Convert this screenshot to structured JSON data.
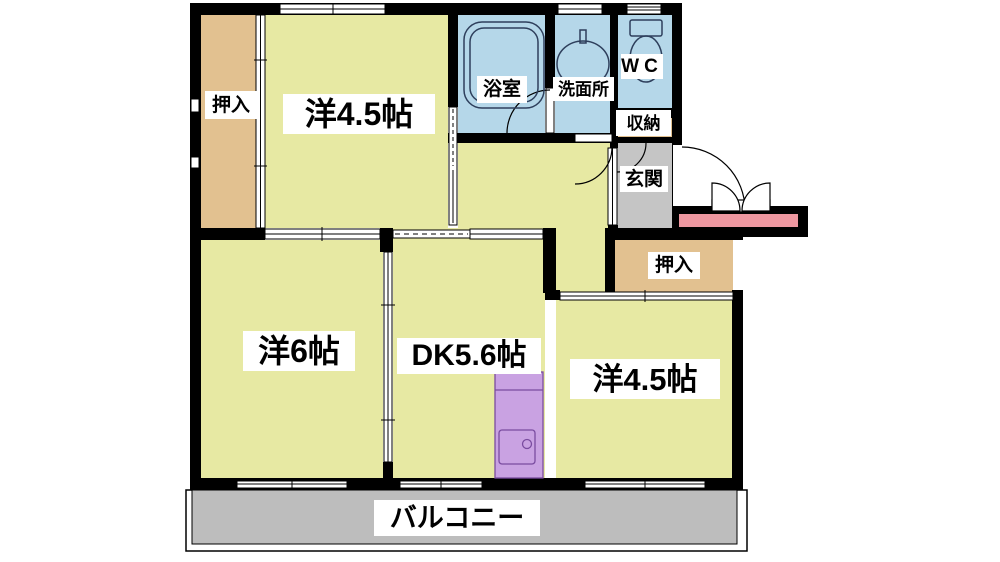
{
  "labels": {
    "closet_top_left": "押入",
    "room_top": "洋4.5帖",
    "bathroom": "浴室",
    "washroom": "洗面所",
    "toilet": "WC",
    "storage": "収納",
    "entrance": "玄関",
    "closet_right": "押入",
    "room_left": "洋6帖",
    "dining_kitchen": "DK5.6帖",
    "room_right": "洋4.5帖",
    "balcony": "バルコニー"
  },
  "colors": {
    "wall": "#000000",
    "room_yellow": "#e7e9a3",
    "closet_tan": "#e2c190",
    "wet_blue": "#b5d7e9",
    "entrance_gray": "#c5c5c5",
    "balcony_gray": "#bdbdbd",
    "porch_pink": "#ee97a0",
    "kitchen_purple": "#c9a2e2",
    "fixture_outline": "#2e3f5c"
  }
}
